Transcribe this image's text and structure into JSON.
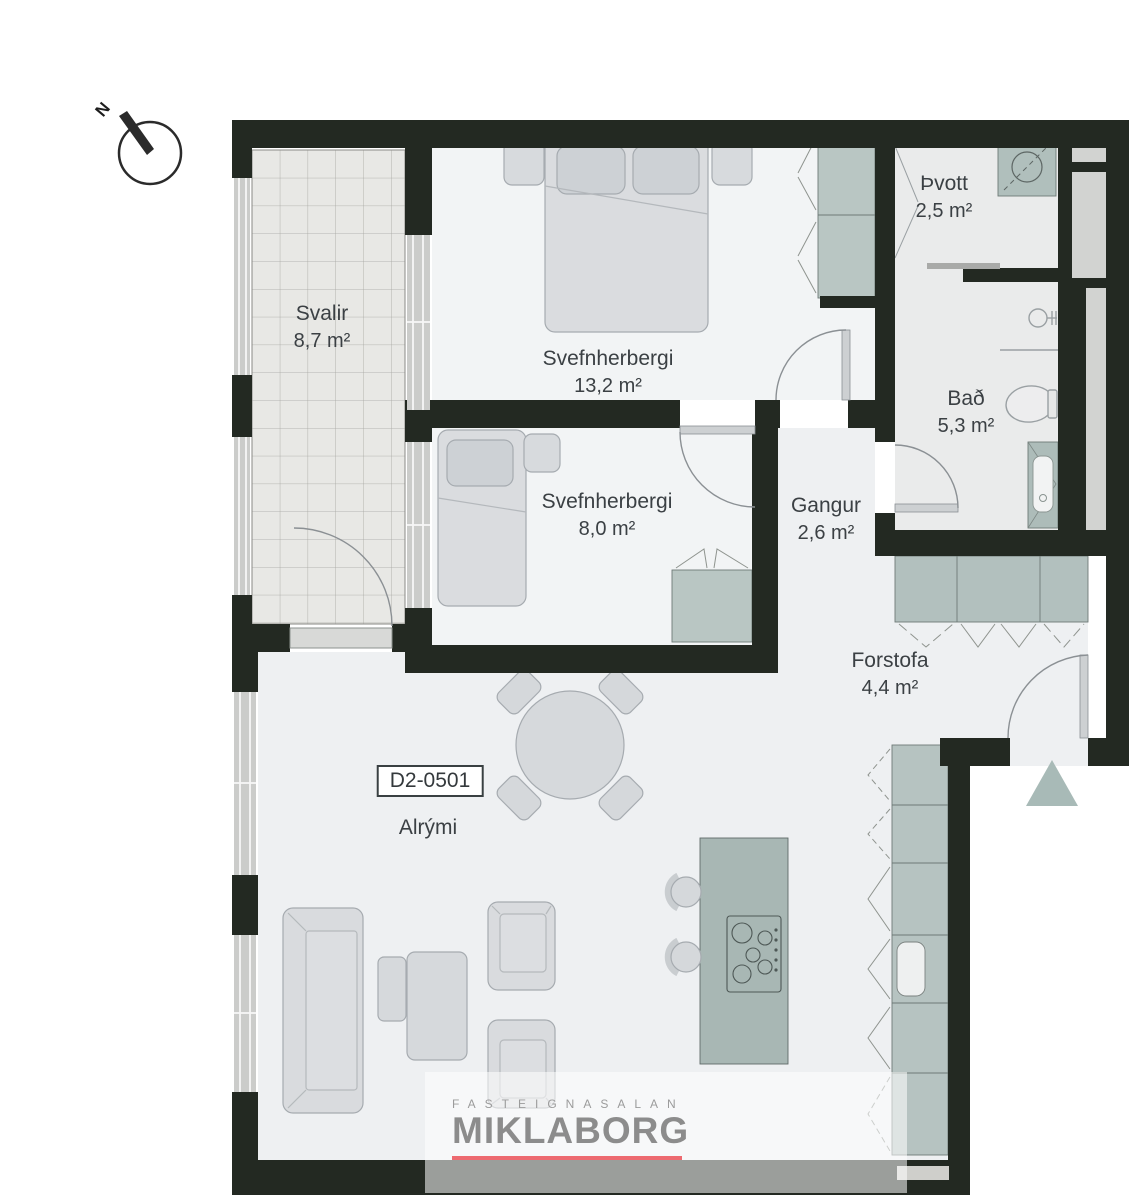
{
  "plan": {
    "compass_north": "N",
    "unit_label": "D2-0501",
    "rooms": [
      {
        "name": "Svalir",
        "area": "8,7 m²"
      },
      {
        "name": "Svefnherbergi",
        "area": "13,2 m²"
      },
      {
        "name": "Þvott",
        "area": "2,5 m²"
      },
      {
        "name": "Bað",
        "area": "5,3 m²"
      },
      {
        "name": "Svefnherbergi",
        "area": "8,0 m²"
      },
      {
        "name": "Gangur",
        "area": "2,6 m²"
      },
      {
        "name": "Forstofa",
        "area": "4,4 m²"
      },
      {
        "name": "Alrými",
        "area": ""
      }
    ],
    "logo": {
      "tagline": "FASTEIGNASALAN",
      "brand": "MIKLABORG"
    },
    "colors": {
      "wall": "#232922",
      "cabinet_green": "#b6c3c1",
      "floor_light": "#eef0f2",
      "accent_red": "#ed6a70",
      "entry_arrow": "#a8bab7"
    }
  }
}
